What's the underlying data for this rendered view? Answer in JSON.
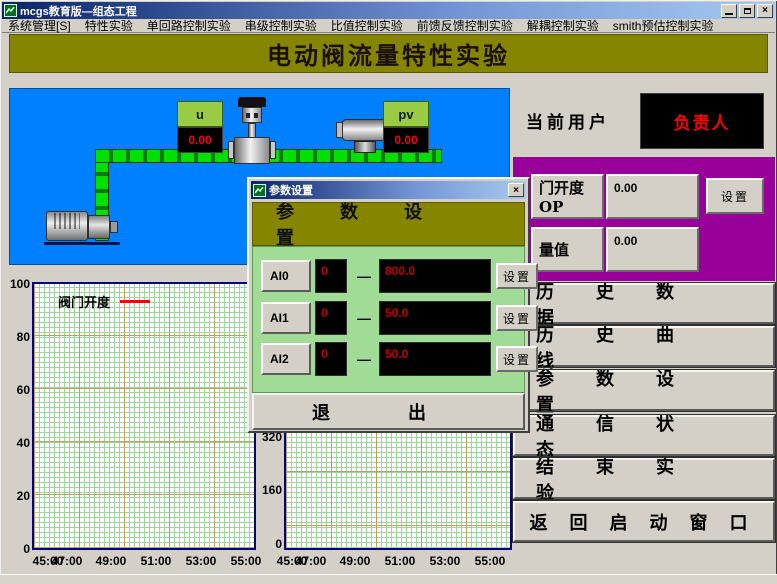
{
  "window": {
    "title": "mcgs教育版—组态工程"
  },
  "menu": {
    "items": [
      "系统管理[S]",
      "特性实验",
      "单回路控制实验",
      "串级控制实验",
      "比值控制实验",
      "前馈反馈控制实验",
      "解耦控制实验",
      "smith预估控制实验"
    ]
  },
  "banner": {
    "title": "电动阀流量特性实验"
  },
  "diagram": {
    "u": {
      "label": "u",
      "value": "0.00"
    },
    "pv": {
      "label": "pv",
      "value": "0.00"
    }
  },
  "user_panel": {
    "label": "当前用户",
    "value": "负责人"
  },
  "control_panel": {
    "op": {
      "label": "门开度OP",
      "value": "0.00",
      "set_label": "设置"
    },
    "flow": {
      "label": "量值",
      "value": "0.00"
    }
  },
  "nav_buttons": [
    "历史数据",
    "历史曲线",
    "参数设置",
    "通信状态",
    "结束实验",
    "返回启动窗口"
  ],
  "dialog": {
    "title": "参数设置",
    "header": "参数设置",
    "rows": [
      {
        "name": "AI0",
        "low": "0",
        "dash": "—",
        "high": "800.0",
        "set_label": "设置"
      },
      {
        "name": "AI1",
        "low": "0",
        "dash": "—",
        "high": "50.0",
        "set_label": "设置"
      },
      {
        "name": "AI2",
        "low": "0",
        "dash": "—",
        "high": "50.0",
        "set_label": "设置"
      }
    ],
    "exit_label": "退出"
  },
  "colors": {
    "banner_bg": "#858500",
    "diagram_bg": "#0080ff",
    "panel_purple": "#990099",
    "dialog_green": "#a0dc96",
    "value_red": "#ff0000",
    "chart_border": "#000080"
  },
  "chart_data": [
    {
      "type": "line",
      "legend": [
        "阀门开度"
      ],
      "legend_color": "#ff0000",
      "series": [
        {
          "name": "阀门开度",
          "values": []
        }
      ],
      "xtick_labels": [
        "45:00",
        "47:00",
        "49:00",
        "51:00",
        "53:00",
        "55:00"
      ],
      "ytick_labels": [
        "100",
        "80",
        "60",
        "40",
        "20",
        "0"
      ],
      "ylim": [
        0,
        100
      ],
      "grid": true
    },
    {
      "type": "line",
      "legend": [],
      "series": [],
      "xtick_labels": [
        "45:00",
        "47:00",
        "49:00",
        "51:00",
        "53:00",
        "55:00"
      ],
      "ytick_labels": [
        "320",
        "160",
        "0"
      ],
      "ylim": [
        0,
        320
      ],
      "grid": true
    }
  ]
}
